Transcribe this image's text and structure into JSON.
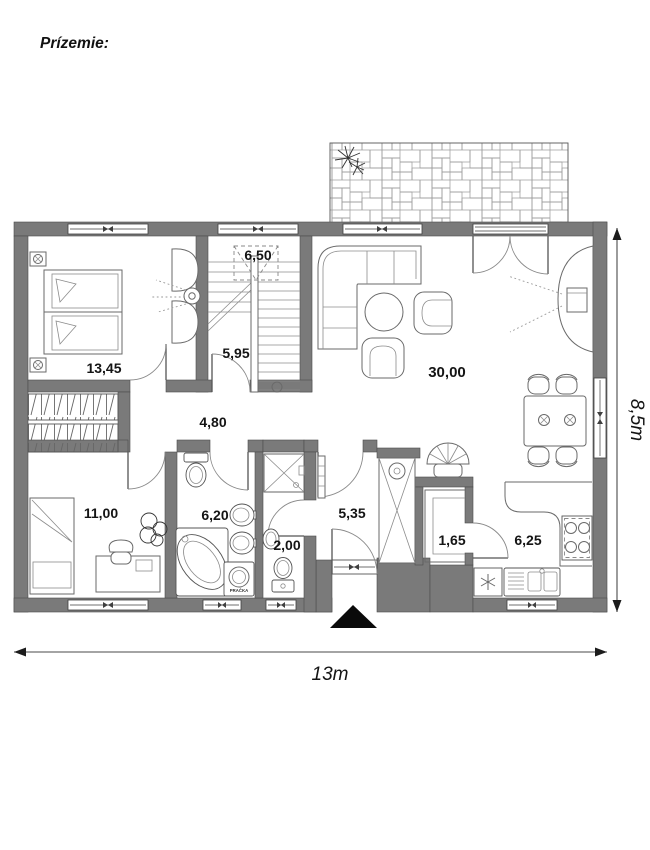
{
  "title": "Prízemie:",
  "rooms": {
    "bedroom_top": {
      "area": "13,45"
    },
    "stair_landing": {
      "area": "6,50"
    },
    "stair_hall": {
      "area": "5,95"
    },
    "corridor": {
      "area": "4,80"
    },
    "living_room": {
      "area": "30,00"
    },
    "bedroom_bottom": {
      "area": "11,00"
    },
    "bathroom": {
      "area": "6,20"
    },
    "wc": {
      "area": "2,00"
    },
    "entry_hall": {
      "area": "5,35"
    },
    "pantry": {
      "area": "1,65"
    },
    "kitchen": {
      "area": "6,25"
    }
  },
  "appliance_labels": {
    "washing_machine": "PRAČKA"
  },
  "dimensions": {
    "total_width": "13m",
    "total_height": "8,5m"
  },
  "colors": {
    "wall_fill": "#7a7a7a",
    "wall_edge": "#4c4c4c",
    "furniture_line": "#6a6a6a",
    "text": "#141414"
  }
}
